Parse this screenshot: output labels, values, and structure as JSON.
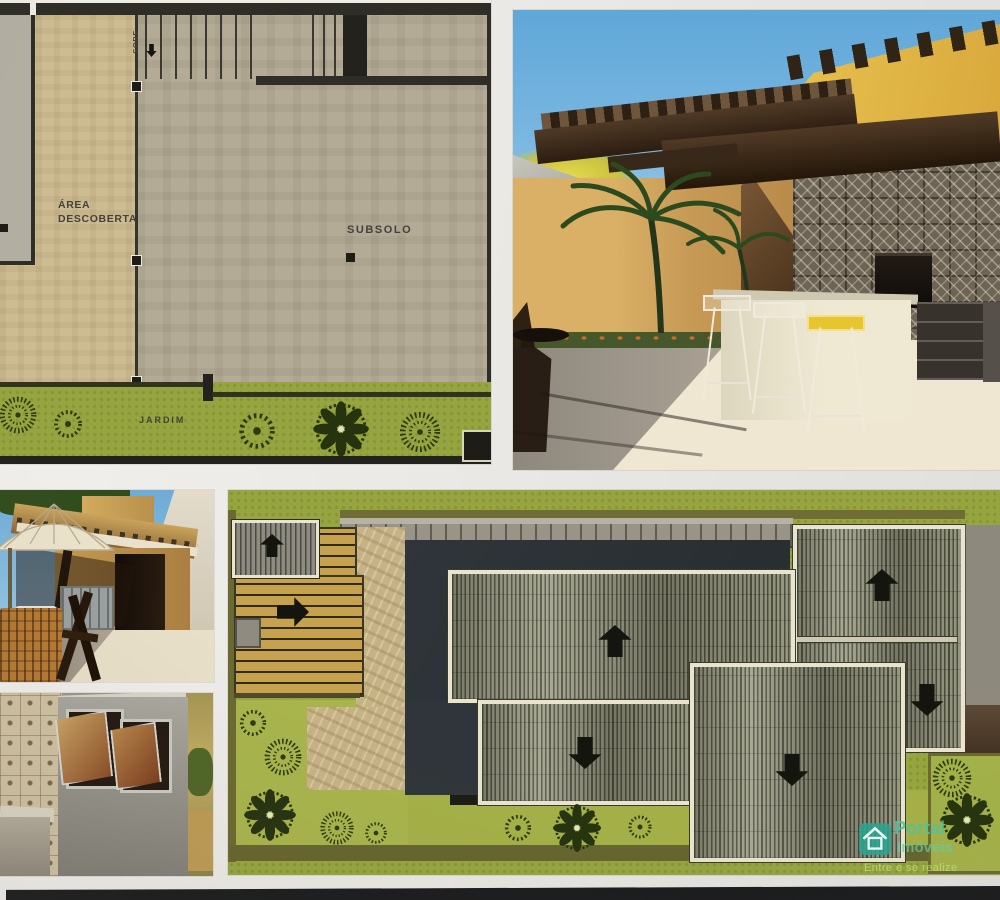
{
  "floor_plan": {
    "labels": {
      "sobe": "SOBE",
      "area_descoberta": "ÁREA\nDESCOBERTA",
      "subsolo": "SUBSOLO",
      "jardim": "JARDIM"
    }
  },
  "roof_plan": {
    "slope_arrows": [
      "up",
      "right",
      "up",
      "down",
      "up",
      "down",
      "down"
    ]
  },
  "watermark": {
    "brand_top": "Portal",
    "brand_bottom": "Imóveis",
    "tagline": "Entre e se realize"
  },
  "icons": {
    "sobe_arrow": "down-arrow-icon",
    "roof_arrows": "roof-slope-arrow-icon",
    "trees": [
      "shrub-ring-tree-icon",
      "fluffy-tree-icon",
      "ornamental-flower-tree-icon"
    ],
    "logo": "house-logo-icon"
  },
  "colors": {
    "grass_green": "#96a53f",
    "garden_light_green": "#a8b44c",
    "plan_beige": "#cdbb92",
    "plan_gray": "#b4ab97",
    "wall_dark": "#2e2d28",
    "charcoal_roof": "#2f353a",
    "deck_wood": "#c7a24e",
    "roof_border_cream": "#e9e4cd",
    "sky_blue": "#6eabd6",
    "watermark_teal": "#2aa491",
    "watermark_tagline": "#b4d877",
    "bottom_band": "#1a1b1d"
  }
}
